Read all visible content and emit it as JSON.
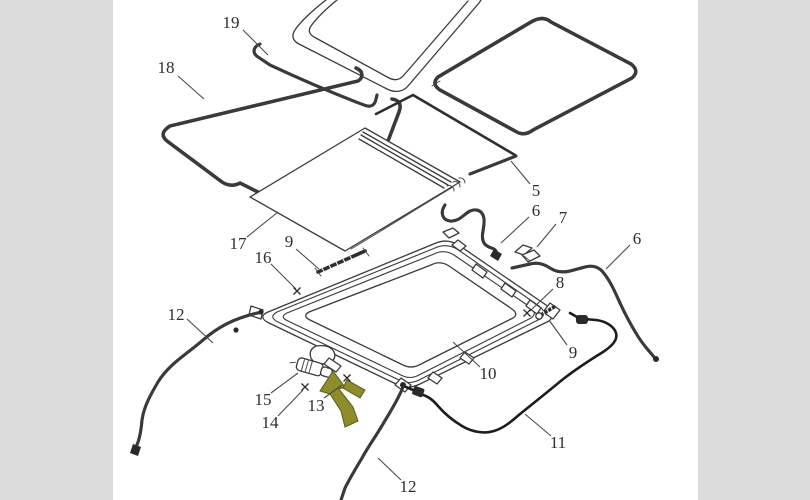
{
  "image": {
    "description": "Exploded parts diagram of a vehicle sunroof assembly with numbered callouts",
    "background_color": "#ffffff",
    "matte_color": "#dcdcdd",
    "line_color": "#3a3a3a"
  },
  "diagram": {
    "labels": [
      {
        "text": "19",
        "x": 118,
        "y": 22,
        "leader": [
          130,
          30,
          155,
          55
        ]
      },
      {
        "text": "18",
        "x": 53,
        "y": 67,
        "leader": [
          65,
          76,
          91,
          99
        ]
      },
      {
        "text": "17",
        "x": 125,
        "y": 243,
        "leader": [
          134,
          237,
          165,
          212
        ]
      },
      {
        "text": "16",
        "x": 150,
        "y": 257,
        "leader": [
          158,
          264,
          183,
          289
        ]
      },
      {
        "text": "9",
        "x": 176,
        "y": 241,
        "leader": [
          183,
          249,
          206,
          269
        ]
      },
      {
        "text": "5",
        "x": 423,
        "y": 190,
        "leader": [
          417,
          184,
          398,
          161
        ]
      },
      {
        "text": "6",
        "x": 423,
        "y": 210,
        "leader": [
          416,
          217,
          388,
          243
        ]
      },
      {
        "text": "7",
        "x": 450,
        "y": 217,
        "leader": [
          443,
          224,
          424,
          247
        ]
      },
      {
        "text": "6",
        "x": 524,
        "y": 238,
        "leader": [
          517,
          245,
          493,
          269
        ]
      },
      {
        "text": "8",
        "x": 447,
        "y": 282,
        "leader": [
          440,
          289,
          417,
          311
        ]
      },
      {
        "text": "9",
        "x": 460,
        "y": 352,
        "leader": [
          454,
          345,
          436,
          320
        ]
      },
      {
        "text": "10",
        "x": 375,
        "y": 373,
        "leader": [
          367,
          367,
          340,
          342
        ]
      },
      {
        "text": "11",
        "x": 445,
        "y": 442,
        "leader": [
          438,
          436,
          412,
          414
        ]
      },
      {
        "text": "12",
        "x": 295,
        "y": 486,
        "leader": [
          288,
          480,
          265,
          458
        ]
      },
      {
        "text": "12",
        "x": 63,
        "y": 314,
        "leader": [
          74,
          319,
          100,
          343
        ]
      },
      {
        "text": "15",
        "x": 150,
        "y": 399,
        "leader": [
          158,
          393,
          185,
          373
        ]
      },
      {
        "text": "14",
        "x": 157,
        "y": 422,
        "leader": [
          165,
          416,
          190,
          390
        ]
      },
      {
        "text": "13",
        "x": 203,
        "y": 405,
        "leader": [
          211,
          398,
          229,
          385
        ]
      }
    ],
    "x_marks": [
      [
        184,
        291
      ],
      [
        192,
        387
      ],
      [
        234,
        378
      ],
      [
        414,
        313
      ]
    ],
    "highlight_arrow": {
      "fill": "#8d8d2c",
      "outline": "#5c5c1e",
      "points_to_label": "13"
    }
  }
}
